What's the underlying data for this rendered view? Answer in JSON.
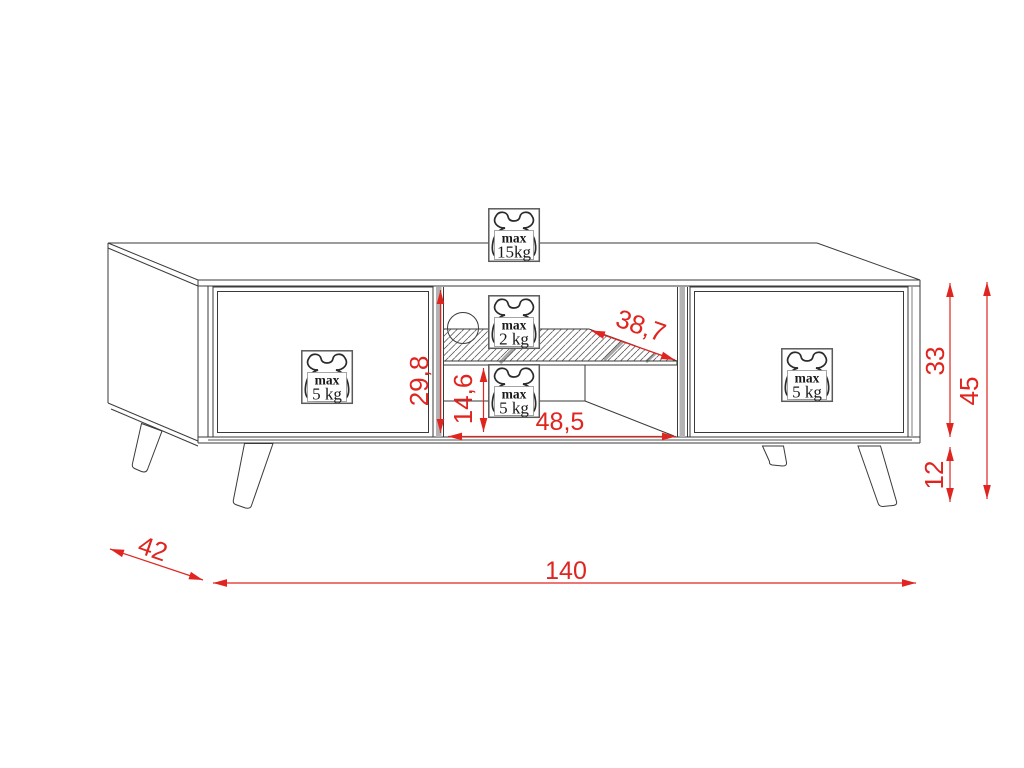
{
  "drawing": {
    "kind": "furniture-technical-drawing",
    "subject": "tv-stand-with-angled-legs"
  },
  "dims": {
    "total_width": "140",
    "depth": "42",
    "total_height": "45",
    "body_height": "33",
    "leg_height": "12",
    "niche_height": "29,8",
    "niche_lower_height": "14,6",
    "niche_width": "48,5",
    "shelf_depth_diagonal": "38,7"
  },
  "badges": {
    "top": {
      "label": "max",
      "value": "15kg"
    },
    "shelf": {
      "label": "max",
      "value": "2 kg"
    },
    "niche_bottom": {
      "label": "max",
      "value": "5 kg"
    },
    "left_door": {
      "label": "max",
      "value": "5 kg"
    },
    "right_door": {
      "label": "max",
      "value": "5 kg"
    }
  },
  "colors": {
    "dimension_red": "#e0241f",
    "line_black": "#3a3a3a",
    "shading_gray": "#a8a8a8"
  }
}
